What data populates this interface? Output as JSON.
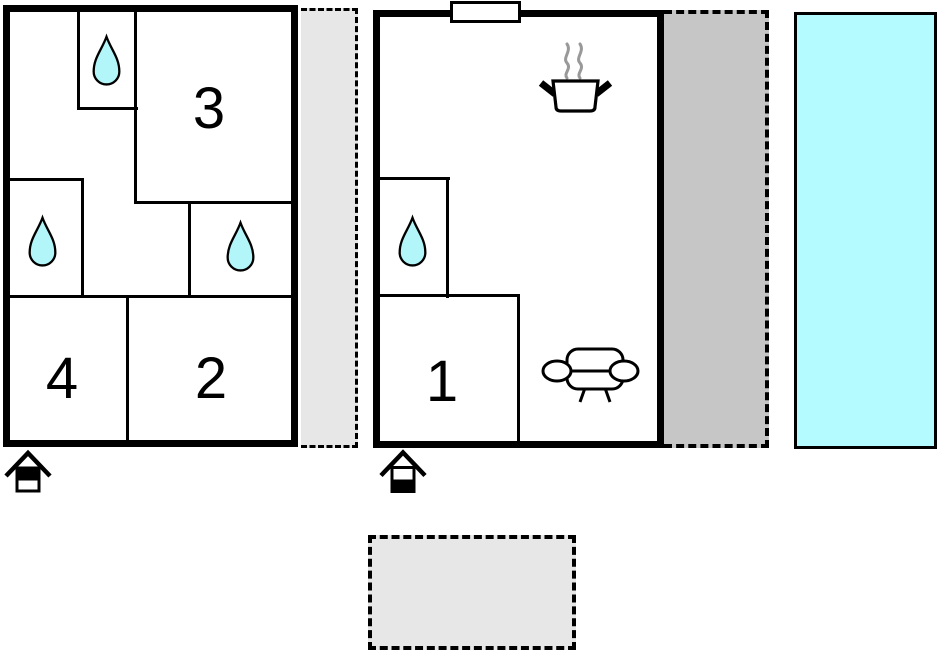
{
  "diagram": {
    "type": "floor-plan",
    "rooms": {
      "r1": {
        "label": "1"
      },
      "r2": {
        "label": "2"
      },
      "r3": {
        "label": "3"
      },
      "r4": {
        "label": "4"
      }
    },
    "colors": {
      "wall": "#000000",
      "background": "#ffffff",
      "water": "#b3f6fa",
      "pool": "#b3fbff",
      "terrace_light": "#e7e7e7",
      "veranda_gray": "#c6c6c6",
      "steam": "#999999",
      "icon_fill": "#ffffff",
      "icon_black": "#000000"
    },
    "icons": {
      "water_drop": "water-drop-icon",
      "cooking_pot": "cooking-pot-icon",
      "sofa": "sofa-icon",
      "entrance": "entrance-house-icon",
      "door": "door-opening"
    }
  }
}
